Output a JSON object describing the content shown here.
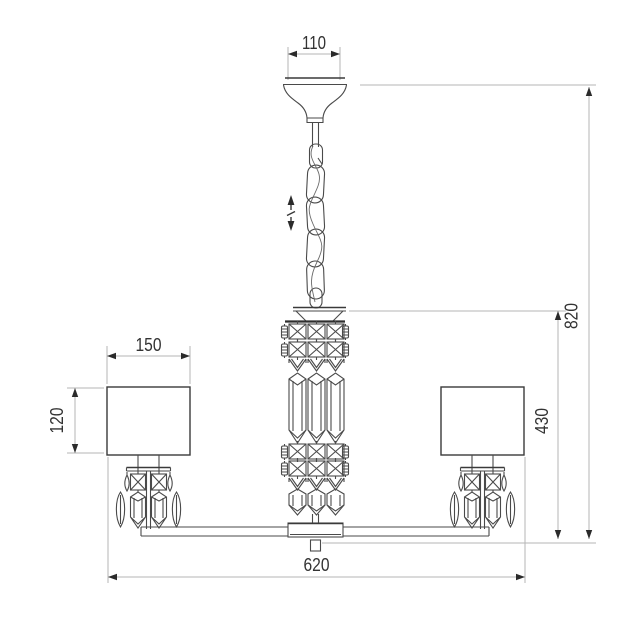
{
  "drawing": {
    "kind": "technical-dimension-diagram",
    "subject": "chandelier",
    "colors": {
      "background": "#ffffff",
      "artwork_line": "#4a4a4a",
      "dimension_line": "#b5b5b5",
      "dimension_text": "#333333"
    },
    "dimensions": {
      "canopy_width": "110",
      "shade_width": "150",
      "shade_height": "120",
      "total_width": "620",
      "overall_height": "820",
      "body_drop_height": "430"
    },
    "icons": {
      "height_adjustable": "up-down-arrows-with-slash"
    }
  }
}
